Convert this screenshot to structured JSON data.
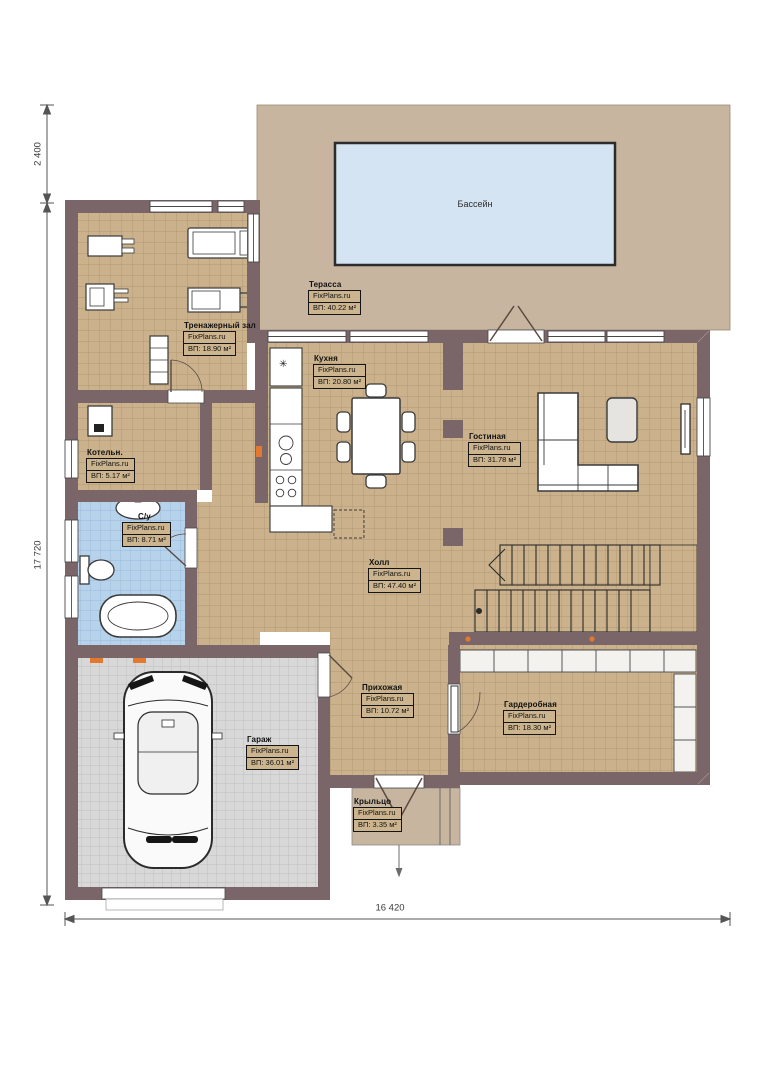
{
  "pool": {
    "label": "Бассейн"
  },
  "rooms": {
    "terrace": {
      "name": "Терасса",
      "site": "FixPlans.ru",
      "area": "ВП: 40.22 м²"
    },
    "gym": {
      "name": "Тренажерный зал",
      "site": "FixPlans.ru",
      "area": "ВП: 18.90 м²"
    },
    "kitchen": {
      "name": "Кухня",
      "site": "FixPlans.ru",
      "area": "ВП: 20.80 м²"
    },
    "living": {
      "name": "Гостиная",
      "site": "FixPlans.ru",
      "area": "ВП: 31.78 м²"
    },
    "boiler": {
      "name": "Котельн.",
      "site": "FixPlans.ru",
      "area": "ВП: 5.17 м²"
    },
    "bathroom": {
      "name": "С/у",
      "site": "FixPlans.ru",
      "area": "ВП: 8.71 м²"
    },
    "hall": {
      "name": "Холл",
      "site": "FixPlans.ru",
      "area": "ВП: 47.40 м²"
    },
    "entry": {
      "name": "Прихожая",
      "site": "FixPlans.ru",
      "area": "ВП: 10.72 м²"
    },
    "wardrobe": {
      "name": "Гардеробная",
      "site": "FixPlans.ru",
      "area": "ВП: 18.30 м²"
    },
    "garage": {
      "name": "Гараж",
      "site": "FixPlans.ru",
      "area": "ВП: 36.01 м²"
    },
    "porch": {
      "name": "Крыльцо",
      "site": "FixPlans.ru",
      "area": "ВП: 3.35 м²"
    }
  },
  "dimensions": {
    "top_left": "2 400",
    "left": "17 720",
    "bottom": "16 420"
  },
  "symbols": {
    "fridge": "✳"
  },
  "colors": {
    "wall": "#7a6568",
    "floor_tile": "#cbb28c",
    "terrace": "#c7b59f",
    "pool": "#d5e4f3",
    "bathroom_tile": "#b7d3eb",
    "garage_tile": "#d8d8d8",
    "accent_orange": "#e2792f"
  }
}
